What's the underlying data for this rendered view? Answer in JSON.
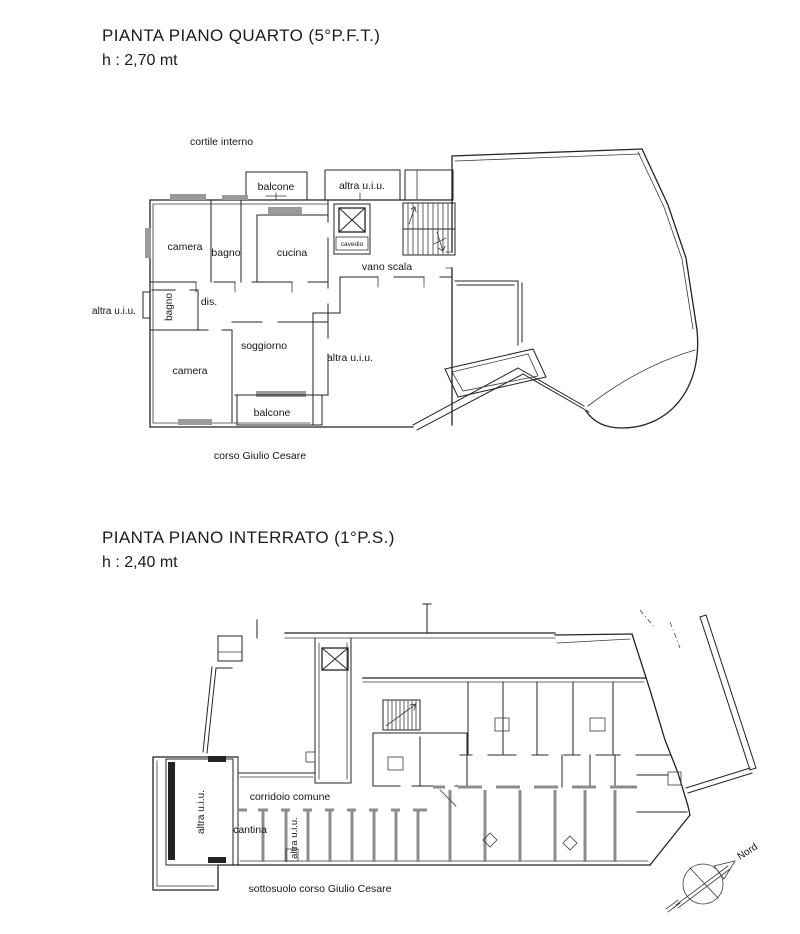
{
  "colors": {
    "ink": "#232323",
    "wall_gray": "#8c8c8c",
    "background": "#ffffff"
  },
  "plan_quarto": {
    "title": "PIANTA PIANO QUARTO (5°P.F.T.)",
    "height_note": "h : 2,70 mt",
    "labels": {
      "courtyard": "cortile interno",
      "balcony_top": "balcone",
      "other_unit_top": "altra u.i.u.",
      "bedroom_top": "camera",
      "bath_top": "bagno",
      "kitchen": "cucina",
      "shaft": "cavedio",
      "stairwell": "vano scala",
      "other_unit_left": "altra u.i.u.",
      "bath_small": "bagno",
      "hall": "dis.",
      "living": "soggiorno",
      "bedroom_bottom": "camera",
      "other_unit_mid": "altra u.i.u.",
      "balcony_bottom": "balcone",
      "street": "corso Giulio Cesare"
    }
  },
  "plan_interrato": {
    "title": "PIANTA PIANO INTERRATO (1°P.S.)",
    "height_note": "h : 2,40 mt",
    "labels": {
      "other_unit_big": "altra u.i.u.",
      "corridor": "corridoio comune",
      "cellar": "cantina",
      "other_unit_small": "altra u.i.u.",
      "street": "sottosuolo corso Giulio Cesare",
      "north": "Nord"
    }
  }
}
